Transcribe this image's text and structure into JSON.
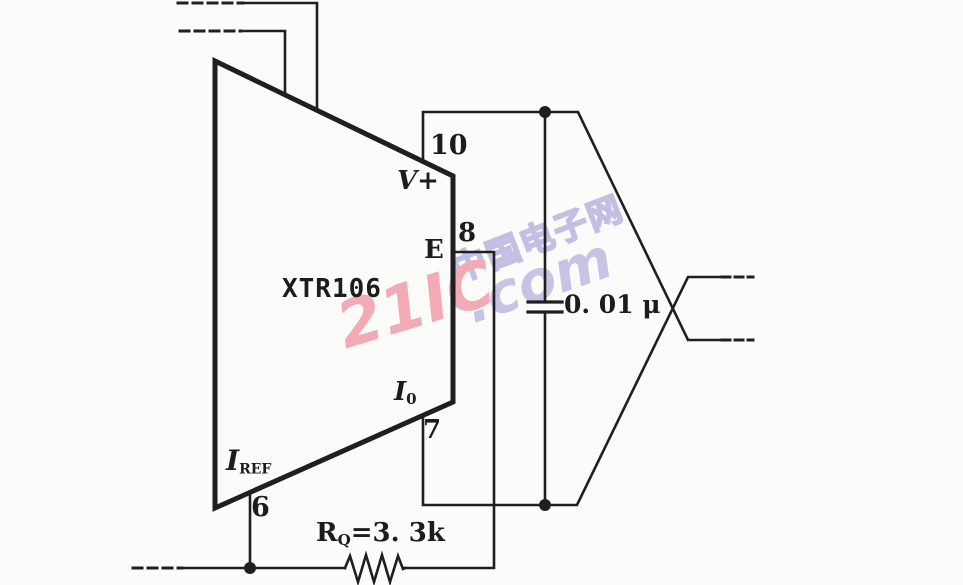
{
  "ic": {
    "part_number": "XTR106"
  },
  "pins": {
    "p10": {
      "num": "10",
      "name": "V+"
    },
    "p8": {
      "num": "8",
      "name": "E"
    },
    "p7": {
      "num": "7",
      "name_main": "I",
      "name_sub": "0"
    },
    "p6": {
      "num": "6",
      "name_main": "I",
      "name_sub": "REF"
    }
  },
  "components": {
    "capacitor_value": "0. 01 μ",
    "resistor": {
      "main": "R",
      "sub": "Q",
      "rest": "=3. 3k"
    }
  },
  "watermark": {
    "brand": "21IC",
    "suffix": ".com",
    "site_name": "中国电子网"
  },
  "colors": {
    "line": "#1f1f1f",
    "watermark_pink": "#f2abb4",
    "watermark_blue": "#c6c2e4"
  }
}
